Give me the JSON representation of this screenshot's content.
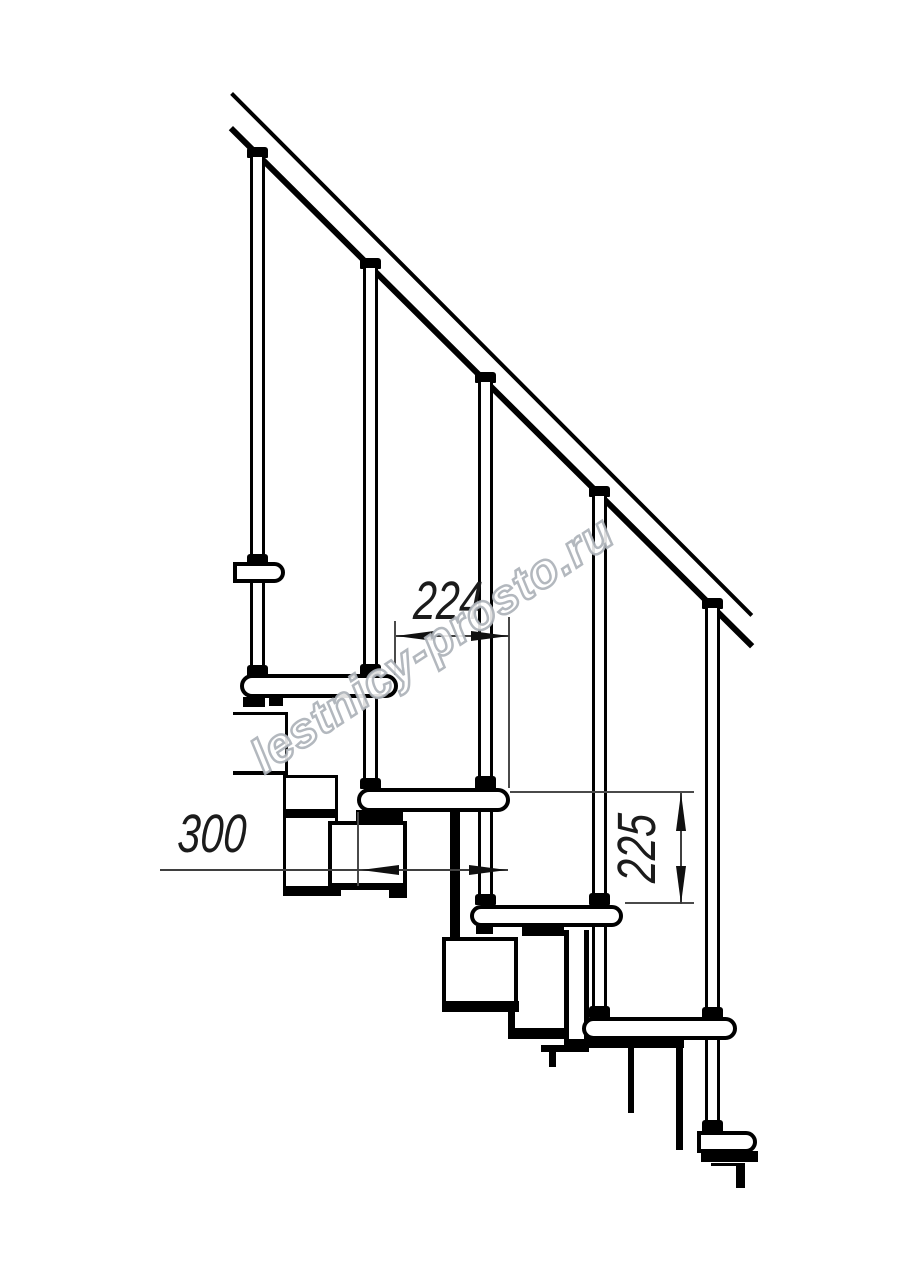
{
  "drawing": {
    "title": "modular staircase side elevation",
    "labels": {
      "going": "224",
      "tread_depth": "300",
      "rise": "225"
    },
    "watermark": {
      "text": "lestnicy-prosto.ru"
    },
    "colors": {
      "background": "#ffffff",
      "line": "#000000",
      "dimension_line": "#3f3f3f",
      "dimension_text": "#1b1b1b",
      "watermark_outline": "#abb0b7"
    }
  }
}
